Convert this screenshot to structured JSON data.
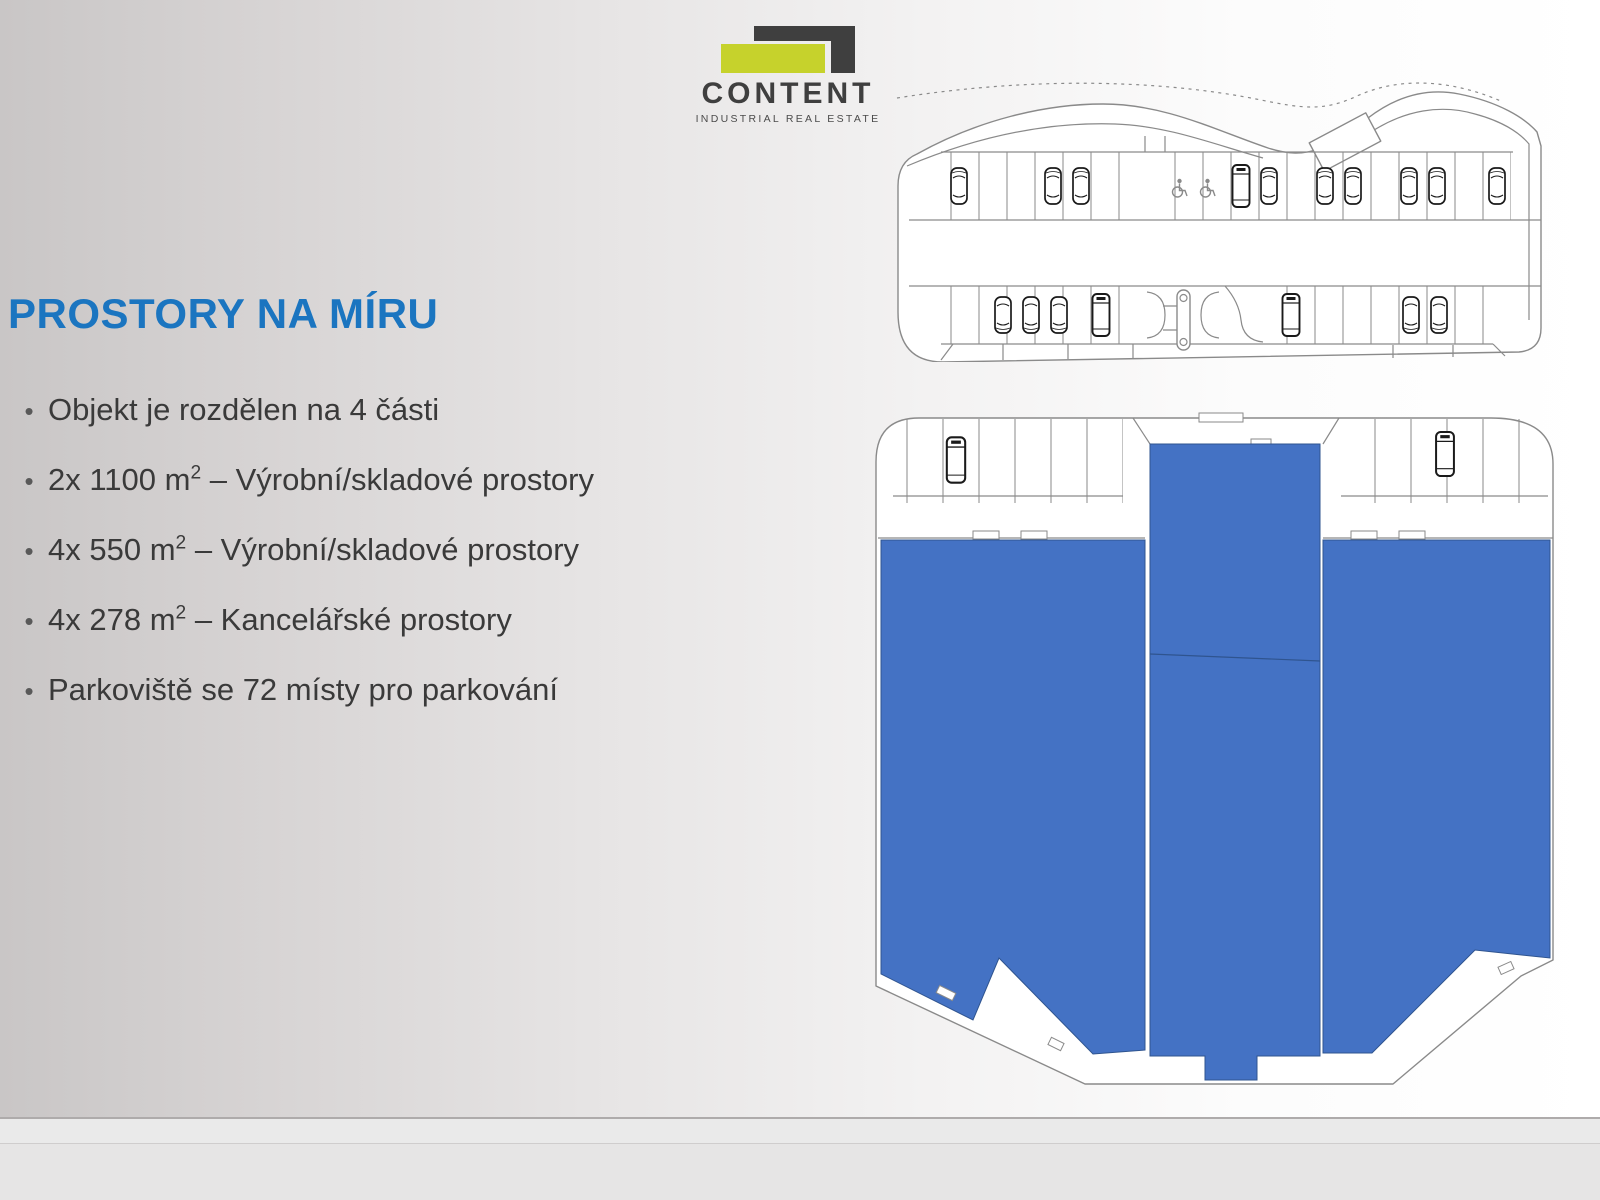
{
  "logo": {
    "name": "CONTENT",
    "tagline": "INDUSTRIAL REAL ESTATE"
  },
  "title": "PROSTORY NA MÍRU",
  "bullet_marker": "•",
  "bullets": [
    {
      "pre": "Objekt je rozdělen na 4 části",
      "sup": "",
      "post": ""
    },
    {
      "pre": "2x 1100 m",
      "sup": "2",
      "post": " – Výrobní/skladové prostory"
    },
    {
      "pre": "4x 550 m",
      "sup": "2",
      "post": " – Výrobní/skladové prostory"
    },
    {
      "pre": "4x 278 m",
      "sup": "2",
      "post": " – Kancelářské prostory"
    },
    {
      "pre": "Parkoviště se 72 místy pro parkování",
      "sup": "",
      "post": ""
    }
  ],
  "icons": {
    "wheelchair": "wheelchair-accessible-parking-symbol",
    "car": "car-top-view",
    "van": "van-top-view"
  },
  "colors": {
    "title_blue": "#1b75c0",
    "logo_dark": "#3f3f3f",
    "logo_green": "#c6d22c",
    "plan_blue": "#4472c4",
    "plan_blue_dark": "#2f548f",
    "plan_line": "#8a8a8a",
    "vehicle_line": "#1a1a1a",
    "text_dark": "#3a3a3a",
    "bullet_gray": "#595959"
  }
}
